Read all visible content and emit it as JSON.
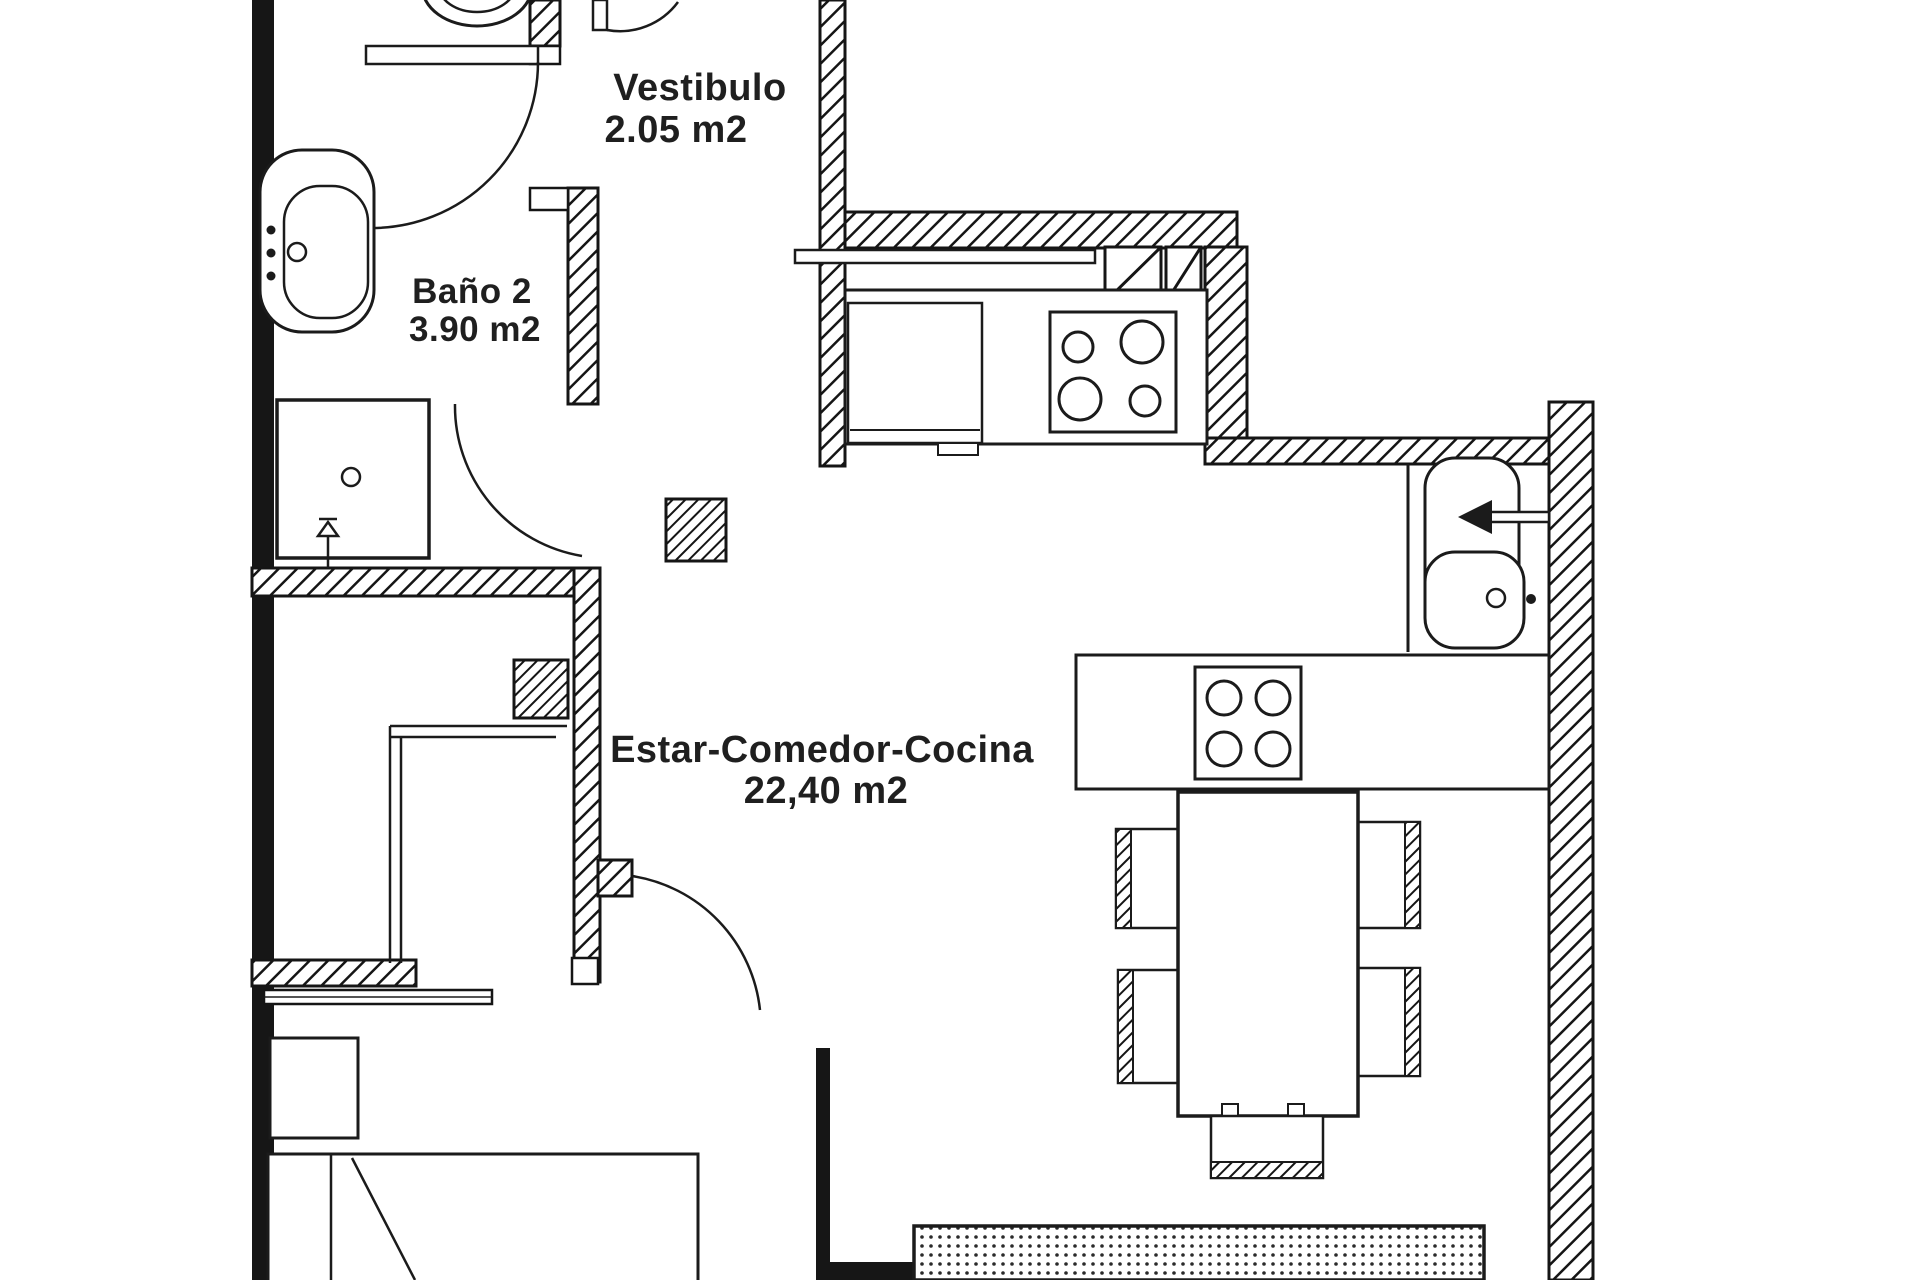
{
  "canvas": {
    "background": "#ffffff",
    "ink": "#1a1a1a"
  },
  "rooms": {
    "vestibulo": {
      "name": "Vestibulo",
      "area": "2.05 m2"
    },
    "bano2": {
      "name": "Baño 2",
      "area": "3.90 m2"
    },
    "estar_comedor_cocina": {
      "name": "Estar-Comedor-Cocina",
      "area": "22,40 m2"
    }
  },
  "fixtures": [
    "toilet",
    "washbasin",
    "shower",
    "shower-valve",
    "bath-door",
    "entrance-door",
    "service-shaft",
    "pillar",
    "kitchen-counter",
    "appliance",
    "cooktop-4-burner",
    "pass-through-bar",
    "double-sink",
    "water-arrow",
    "island-hob",
    "dining-table",
    "chair",
    "rug",
    "bed",
    "nightstand",
    "wardrobe",
    "bedroom-door"
  ]
}
